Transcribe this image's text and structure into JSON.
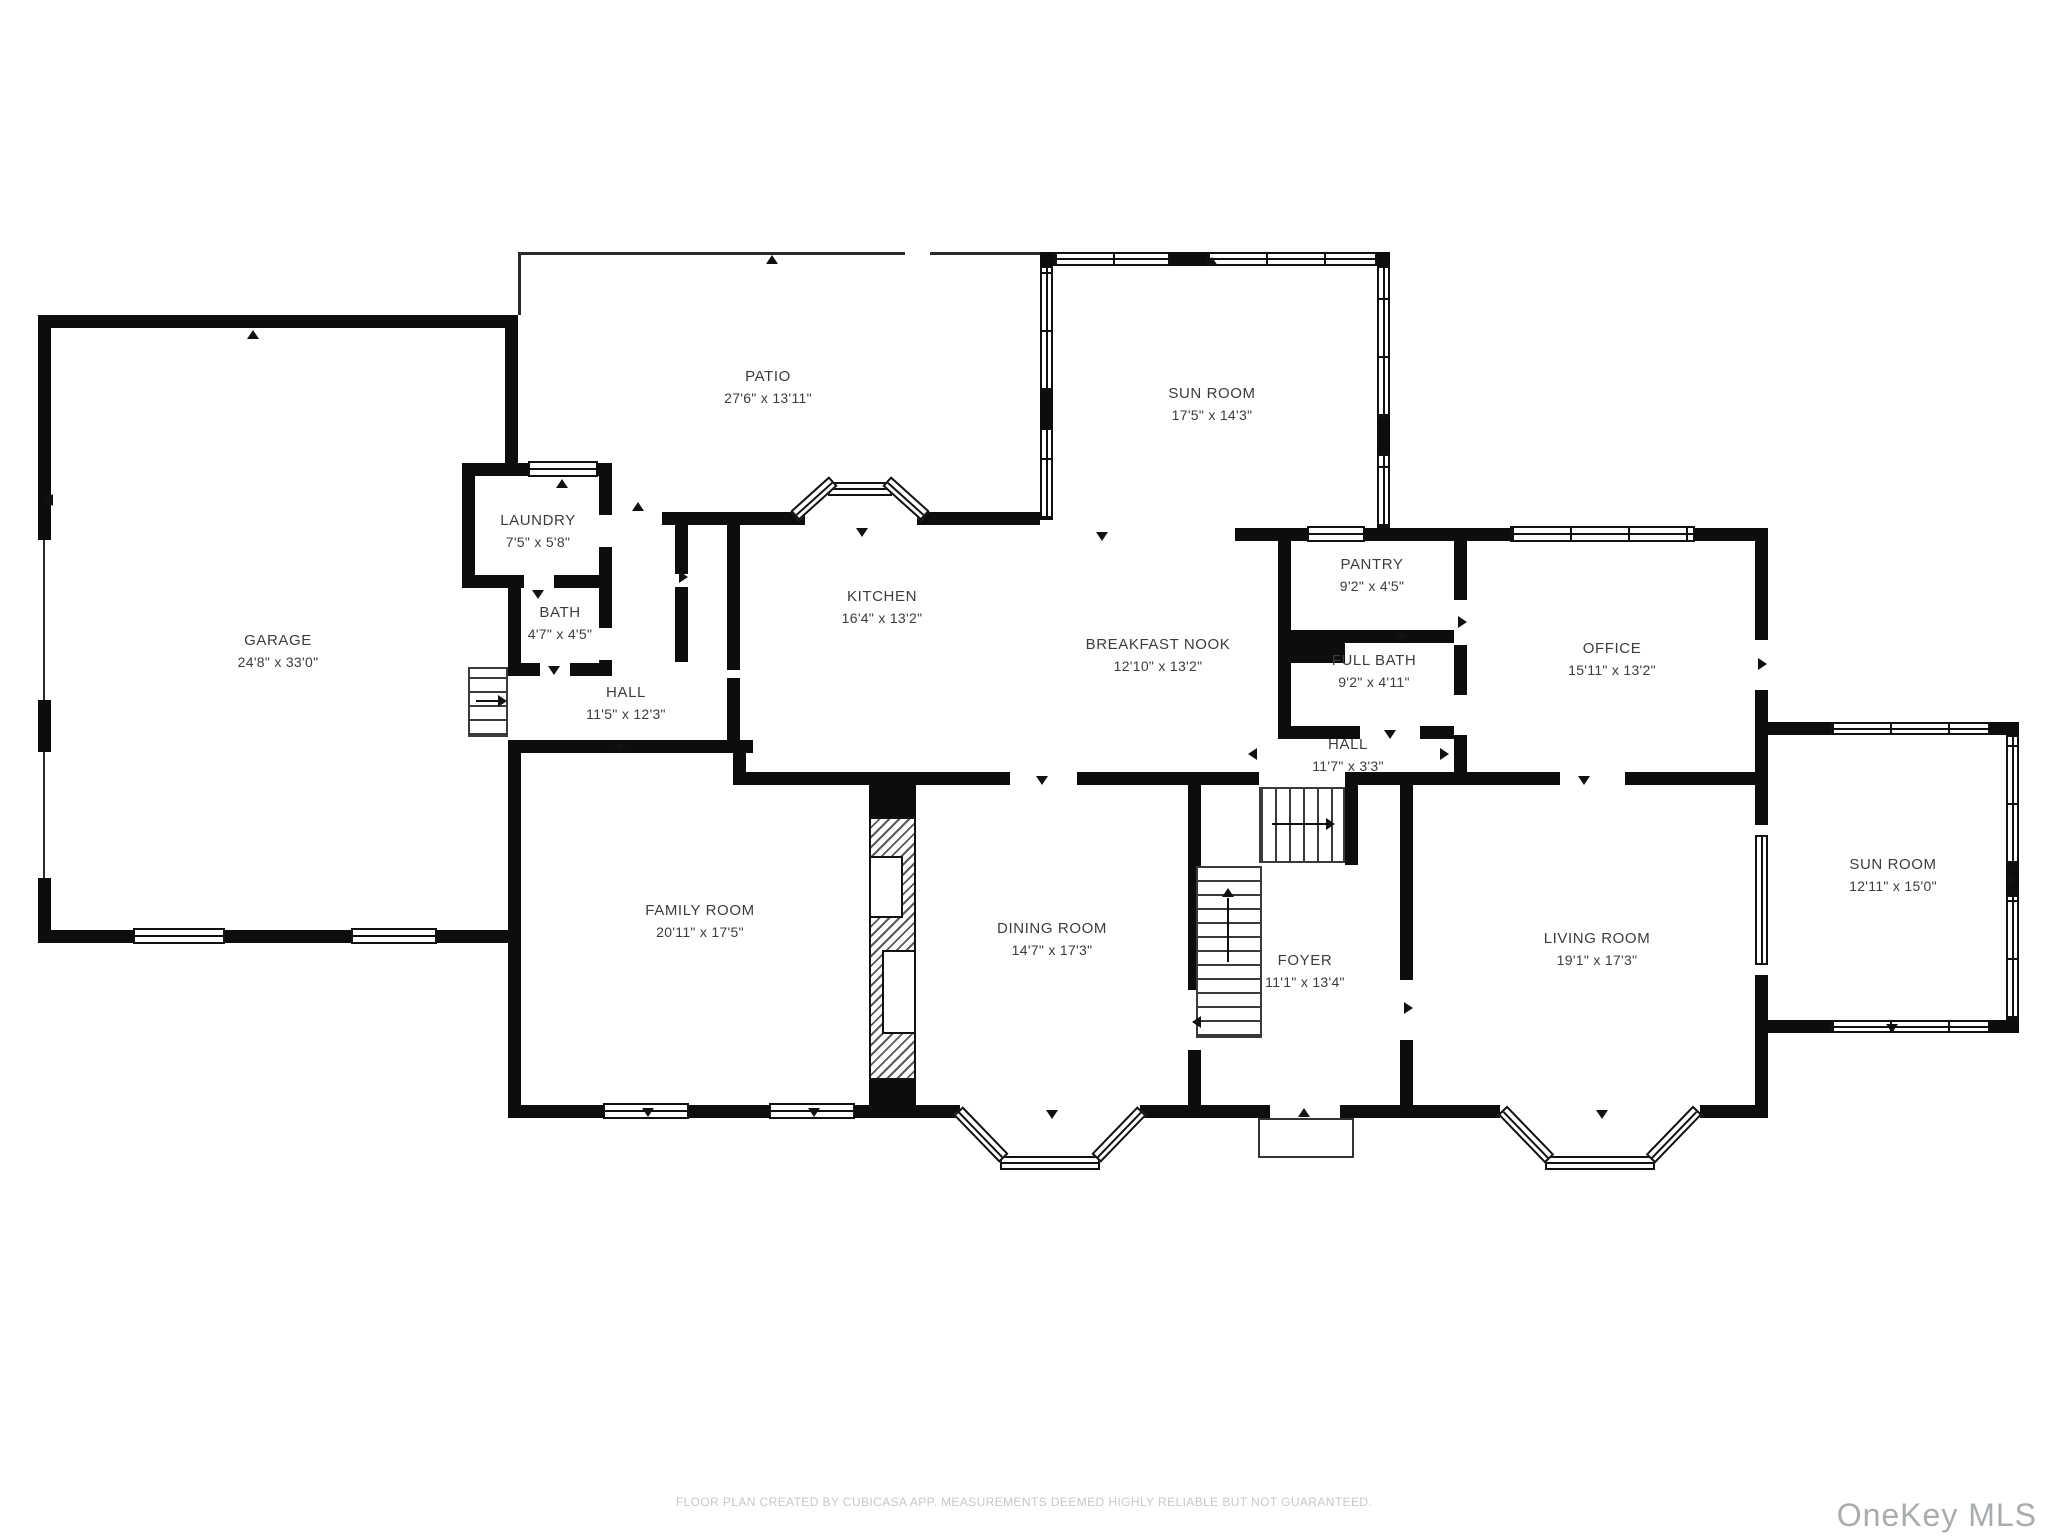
{
  "plan": {
    "rooms": [
      {
        "name": "GARAGE",
        "dims": "24'8\" x 33'0\""
      },
      {
        "name": "PATIO",
        "dims": "27'6\" x 13'11\""
      },
      {
        "name": "SUN ROOM",
        "dims": "17'5\" x 14'3\""
      },
      {
        "name": "LAUNDRY",
        "dims": "7'5\" x 5'8\""
      },
      {
        "name": "BATH",
        "dims": "4'7\" x 4'5\""
      },
      {
        "name": "HALL",
        "dims": "11'5\" x 12'3\""
      },
      {
        "name": "KITCHEN",
        "dims": "16'4\" x 13'2\""
      },
      {
        "name": "BREAKFAST NOOK",
        "dims": "12'10\" x 13'2\""
      },
      {
        "name": "PANTRY",
        "dims": "9'2\" x 4'5\""
      },
      {
        "name": "FULL BATH",
        "dims": "9'2\" x 4'11\""
      },
      {
        "name": "HALL",
        "dims": "11'7\" x 3'3\""
      },
      {
        "name": "OFFICE",
        "dims": "15'11\" x 13'2\""
      },
      {
        "name": "SUN ROOM",
        "dims": "12'11\" x 15'0\""
      },
      {
        "name": "FAMILY ROOM",
        "dims": "20'11\" x 17'5\""
      },
      {
        "name": "DINING ROOM",
        "dims": "14'7\" x 17'3\""
      },
      {
        "name": "FOYER",
        "dims": "11'1\" x 13'4\""
      },
      {
        "name": "LIVING ROOM",
        "dims": "19'1\" x 17'3\""
      }
    ],
    "footer": "FLOOR PLAN CREATED BY CUBICASA APP. MEASUREMENTS DEEMED HIGHLY RELIABLE BUT NOT GUARANTEED.",
    "watermark": "OneKey MLS",
    "colors": {
      "wall": "#0d0d0d",
      "background": "#ffffff",
      "label": "#3c3c3c",
      "footer": "#c7c7c7",
      "watermark": "#a9acae"
    }
  }
}
